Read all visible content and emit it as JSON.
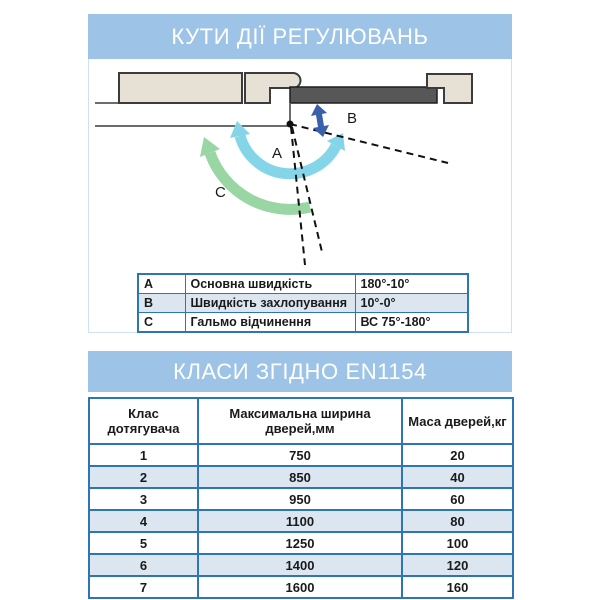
{
  "section1": {
    "title": "КУТИ ДІЇ РЕГУЛЮВАНЬ",
    "diagram": {
      "labels": {
        "a": "A",
        "b": "B",
        "c": "C"
      },
      "colors": {
        "header_bar": "#9dc3e6",
        "arc_a_cyan": "#85d5e8",
        "arc_c_green": "#99d6a4",
        "arrow_b_blue": "#3a60ab",
        "door_gray": "#575757",
        "wall_beige": "#e7e0d5",
        "outline_dark": "#3c3c3c",
        "table_border_blue": "#2e75b6",
        "alt_row_blue": "#dce6f1"
      }
    },
    "legend": {
      "rows": [
        {
          "key": "A",
          "label": "Основна швидкість",
          "value": "180°-10°"
        },
        {
          "key": "B",
          "label": "Швидкість захлопування",
          "value": "10°-0°"
        },
        {
          "key": "C",
          "label": "Гальмо відчинення",
          "value": "ВС 75°-180°"
        }
      ]
    }
  },
  "section2": {
    "title": "КЛАСИ ЗГІДНО EN1154",
    "table": {
      "headers": [
        "Клас дотягувача",
        "Максимальна ширина дверей,мм",
        "Маса дверей,кг"
      ],
      "rows": [
        {
          "cls": "1",
          "width": "750",
          "mass": "20"
        },
        {
          "cls": "2",
          "width": "850",
          "mass": "40"
        },
        {
          "cls": "3",
          "width": "950",
          "mass": "60"
        },
        {
          "cls": "4",
          "width": "1100",
          "mass": "80"
        },
        {
          "cls": "5",
          "width": "1250",
          "mass": "100"
        },
        {
          "cls": "6",
          "width": "1400",
          "mass": "120"
        },
        {
          "cls": "7",
          "width": "1600",
          "mass": "160"
        }
      ]
    }
  }
}
